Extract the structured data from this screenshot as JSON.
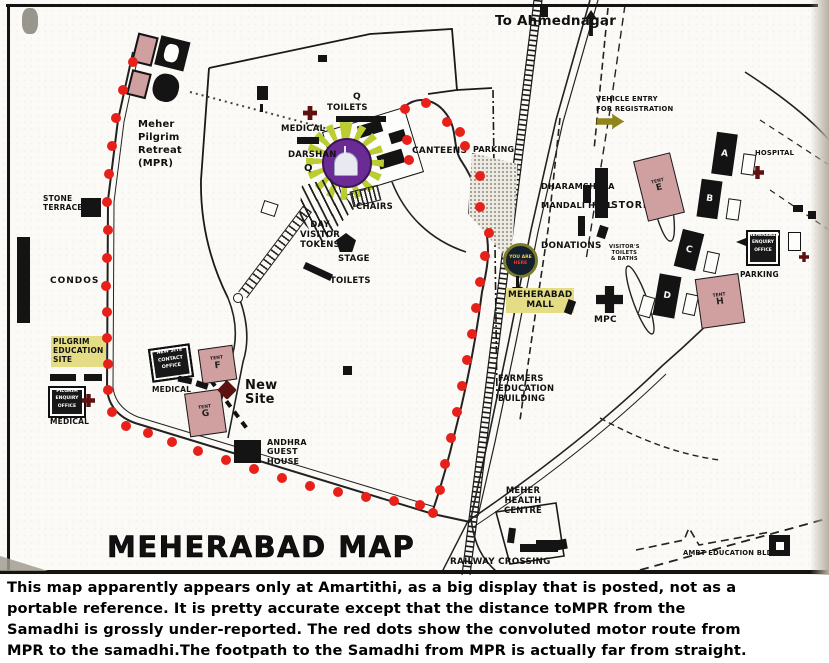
{
  "title": "MEHERABAD MAP",
  "colors": {
    "route_red": "#e7201a",
    "tent_pink": "#d0a0a1",
    "samadhi_purple": "#6b2b95",
    "starburst_green": "#bccd31",
    "cross_red": "#5f1010",
    "arrow_olive": "#8f851c",
    "highlight_yellow": "#e4dd86"
  },
  "labels": {
    "to_ahmednagar": "To Ahmednagar",
    "mpr": "Meher\nPilgrim\nRetreat\n(MPR)",
    "stone_terrace": "STONE\nTERRACE",
    "condos": "CONDOS",
    "pilgrim_education": "PILGRIM\nEDUCATION\nSITE",
    "pilgrim_enquiry_sign": "PILGRIM\nENQUIRY\nOFFICE",
    "medical_left": "MEDICAL",
    "new_site_office_sign": "NEW SITE\nCONTACT\nOFFICE",
    "medical_new_site": "MEDICAL",
    "new_site": "New\nSite",
    "andhra_guest_house": "ANDHRA\nGUEST\nHOUSE",
    "toilets_top": "TOILETS",
    "medical_center": "MEDICAL",
    "darshan": "DARSHAN",
    "darshan_q": "Q",
    "q_marker": "Q",
    "chairs": "CHAIRS",
    "day_visitor_tokens": "DAY\nVISITOR\nTOKENS",
    "stage": "STAGE",
    "toilets_bottom": "TOILETS",
    "canteens": "CANTEENS",
    "parking_top": "PARKING",
    "vehicle_entry": "VEHICLE ENTRY\nFOR REGISTRATION",
    "dharamshala": "DHARAMSHALA",
    "mandali_hall": "MANDALI HALL",
    "store": "STORE",
    "donations": "DONATIONS",
    "visitors_toilets": "VISITOR'S\nTOILETS\n& BATHS",
    "you_are_here_top": "YOU ARE",
    "you_are_here_bottom": "HERE",
    "meherabad_mall": "MEHERABAD\nMALL",
    "mpc": "MPC",
    "hospital": "HOSPITAL",
    "parking_right": "PARKING",
    "enquiry_right_sign": "MEHERABAD\nENQUIRY\nOFFICE",
    "farmers_education": "FARMERS\nEDUCATION\nBUILDING",
    "meher_health_centre": "MEHER\nHEALTH\nCENTRE",
    "railway_crossing": "RAILWAY CROSSING",
    "ambt": "AMBT EDUCATION BLDG.",
    "map_title": "MEHERABAD MAP"
  },
  "tents": {
    "e": {
      "label": "TENT",
      "letter": "E"
    },
    "f": {
      "label": "TENT",
      "letter": "F"
    },
    "g": {
      "label": "TENT",
      "letter": "G"
    },
    "h": {
      "label": "TENT",
      "letter": "H"
    }
  },
  "buildings": {
    "a": "A",
    "b": "B",
    "c": "C",
    "d": "D"
  },
  "route_dots": [
    [
      133,
      62
    ],
    [
      123,
      90
    ],
    [
      116,
      118
    ],
    [
      112,
      146
    ],
    [
      109,
      174
    ],
    [
      107,
      202
    ],
    [
      108,
      230
    ],
    [
      107,
      258
    ],
    [
      106,
      286
    ],
    [
      107,
      312
    ],
    [
      107,
      338
    ],
    [
      108,
      364
    ],
    [
      108,
      390
    ],
    [
      112,
      412
    ],
    [
      126,
      426
    ],
    [
      148,
      433
    ],
    [
      172,
      442
    ],
    [
      198,
      451
    ],
    [
      226,
      460
    ],
    [
      254,
      469
    ],
    [
      282,
      478
    ],
    [
      310,
      486
    ],
    [
      338,
      492
    ],
    [
      366,
      497
    ],
    [
      394,
      501
    ],
    [
      420,
      505
    ],
    [
      433,
      513
    ],
    [
      440,
      490
    ],
    [
      445,
      464
    ],
    [
      451,
      438
    ],
    [
      457,
      412
    ],
    [
      462,
      386
    ],
    [
      467,
      360
    ],
    [
      472,
      334
    ],
    [
      476,
      308
    ],
    [
      480,
      282
    ],
    [
      485,
      256
    ],
    [
      489,
      233
    ],
    [
      480,
      207
    ],
    [
      480,
      176
    ],
    [
      465,
      146
    ],
    [
      460,
      132
    ],
    [
      447,
      122
    ],
    [
      426,
      103
    ],
    [
      405,
      109
    ],
    [
      407,
      140
    ],
    [
      409,
      160
    ]
  ],
  "caption": {
    "lines": [
      "This map apparently appears only at Amartithi, as a big display that is posted, not as a",
      "portable reference.  It is pretty accurate except that the distance toMPR from the",
      "Samadhi is grossly under-reported.  The red dots show the convoluted motor route from",
      "MPR to the samadhi.The footpath to the Samadhi from MPR is actually far from straight."
    ]
  }
}
